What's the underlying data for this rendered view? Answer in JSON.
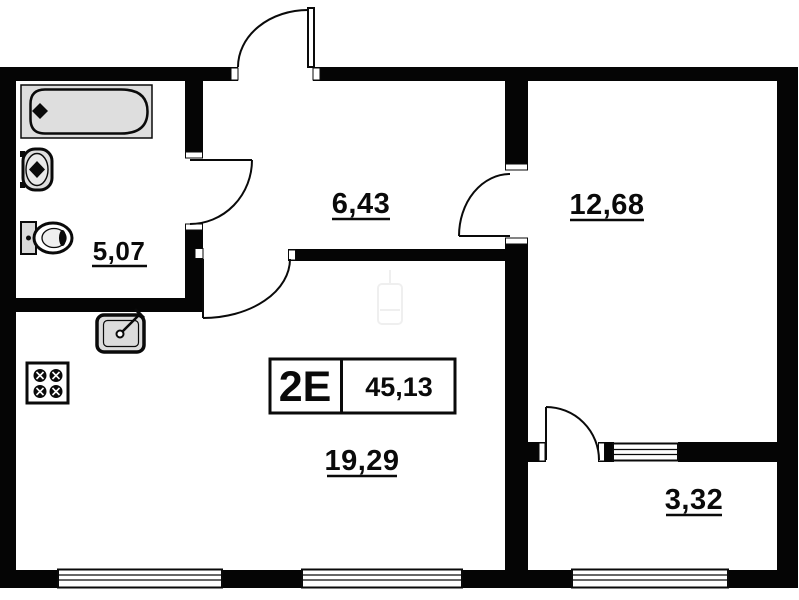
{
  "unit": {
    "label": "2E",
    "total_area": "45,13"
  },
  "rooms": {
    "bathroom": {
      "area": "5,07"
    },
    "hallway": {
      "area": "6,43"
    },
    "bedroom": {
      "area": "12,68"
    },
    "living_kitchen": {
      "area": "19,29"
    },
    "balcony": {
      "area": "3,32"
    }
  },
  "colors": {
    "wall": "#050505",
    "fixture_fill": "#dedede",
    "background": "#ffffff",
    "line": "#0a0a0a"
  },
  "fixtures": [
    "bathtub",
    "washbasin",
    "toilet",
    "kitchen-sink",
    "stove"
  ]
}
